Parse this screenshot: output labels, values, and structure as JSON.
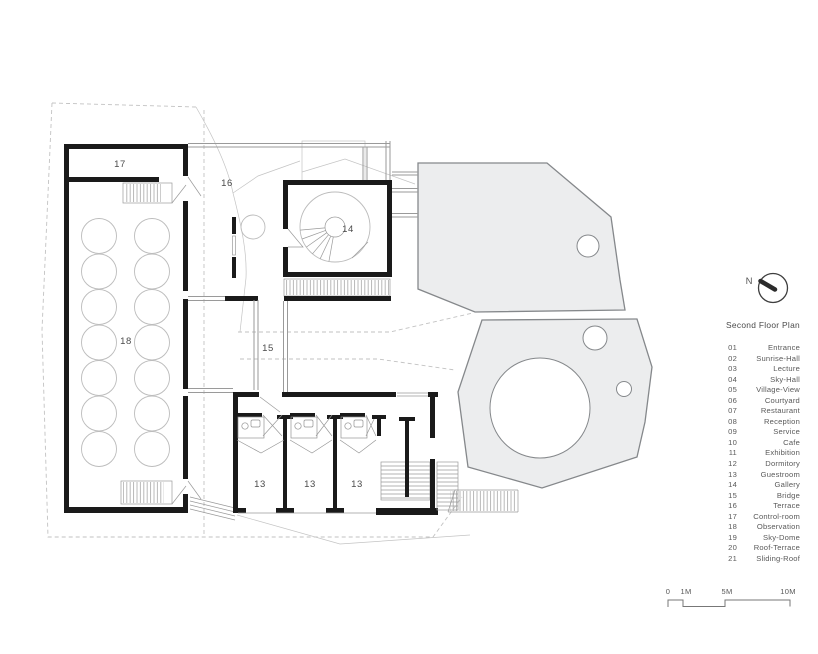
{
  "colors": {
    "wall": "#1a1a1a",
    "thin_line": "#9a9a9a",
    "light_line": "#c4c4c4",
    "dashed": "#c2c2c2",
    "terrace_fill": "#ecedee",
    "terrace_stroke": "#85888b",
    "text": "#4b4b4b",
    "legend_text": "#5a5a5a"
  },
  "labels": [
    "17",
    "16",
    "14",
    "18",
    "15",
    "13",
    "13",
    "13"
  ],
  "north": {
    "label": "N"
  },
  "scale_bar": {
    "labels": [
      "0",
      "1M",
      "5M",
      "10M"
    ]
  },
  "legend": {
    "title": "Second Floor Plan",
    "entries": [
      {
        "num": "01",
        "name": "Entrance"
      },
      {
        "num": "02",
        "name": "Sunrise-Hall"
      },
      {
        "num": "03",
        "name": "Lecture"
      },
      {
        "num": "04",
        "name": "Sky-Hall"
      },
      {
        "num": "05",
        "name": "Village-View"
      },
      {
        "num": "06",
        "name": "Courtyard"
      },
      {
        "num": "07",
        "name": "Restaurant"
      },
      {
        "num": "08",
        "name": "Reception"
      },
      {
        "num": "09",
        "name": "Service"
      },
      {
        "num": "10",
        "name": "Cafe"
      },
      {
        "num": "11",
        "name": "Exhibition"
      },
      {
        "num": "12",
        "name": "Dormitory"
      },
      {
        "num": "13",
        "name": "Guestroom"
      },
      {
        "num": "14",
        "name": "Gallery"
      },
      {
        "num": "15",
        "name": "Bridge"
      },
      {
        "num": "16",
        "name": "Terrace"
      },
      {
        "num": "17",
        "name": "Control-room"
      },
      {
        "num": "18",
        "name": "Observation"
      },
      {
        "num": "19",
        "name": "Sky-Dome"
      },
      {
        "num": "20",
        "name": "Roof-Terrace"
      },
      {
        "num": "21",
        "name": "Sliding-Roof"
      }
    ]
  }
}
